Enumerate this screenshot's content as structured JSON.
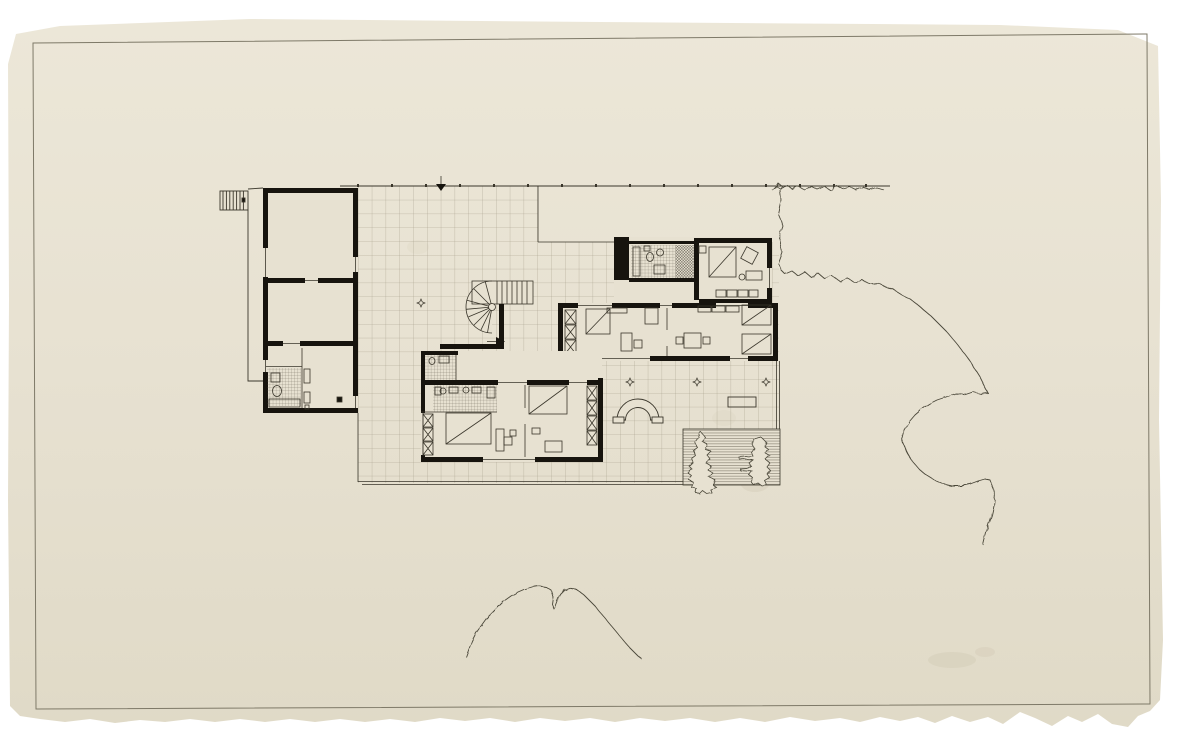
{
  "scene": {
    "description": "Scanned ink-on-paper architectural ground-floor plan of a modernist house: gridded terrace, spiral stair, three building wings, garden bed and freehand tree outlines on aged cream paper with a ruled border and torn bottom edge",
    "visible_text": ""
  },
  "colors": {
    "background": "#ffffff",
    "paper_top": "#ece7d8",
    "paper_mid": "#e7e1d1",
    "paper_bottom": "#e0dac7",
    "border_line": "#7e7968",
    "ink_heavy": "#17140e",
    "ink_medium": "#3a362b",
    "ink_light": "#6e685a",
    "grid_line": "#a49c88",
    "tile_line": "#5f594b",
    "tree_line": "#4a4639",
    "stain": "#b2a78c"
  },
  "plan": {
    "regions": [
      "terrace-paving-grid",
      "service-wing-left",
      "kitchen-bath-wing-top",
      "bedroom-wing-middle",
      "bedroom-wing-lower",
      "spiral-stair",
      "entry-stair-upper-left",
      "garden-arch",
      "planting-bed",
      "property-line",
      "tree-outline-right",
      "tree-outline-bottom"
    ]
  }
}
